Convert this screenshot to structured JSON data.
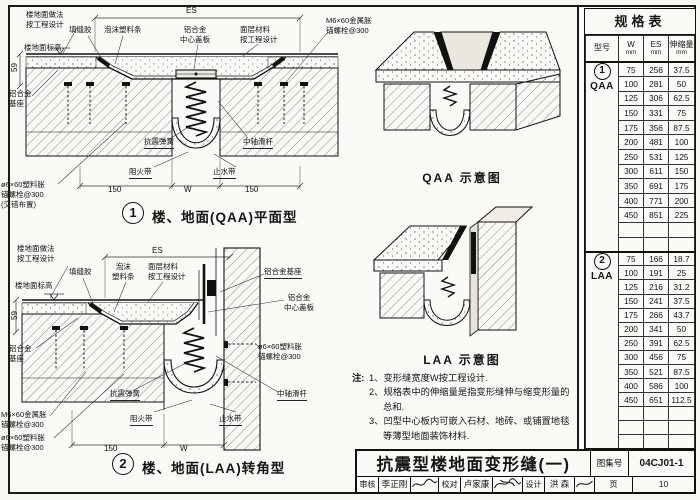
{
  "page": {
    "bg": "#f7f6f1",
    "line": "#1a1a1a"
  },
  "drawing1": {
    "caption_no": "1",
    "caption": "楼、地面(QAA)平面型",
    "dims": {
      "es": "ES",
      "h59": "59",
      "left150": "150",
      "w": "W",
      "right150": "150"
    },
    "labels": {
      "floor_finish": "楼地面做法\n按工程设计",
      "sealant": "填缝胶",
      "foam_strip": "泡沫塑料条",
      "alu_center_plate": "铝合金\n中心盖板",
      "surface_material": "面层材料\n按工程设计",
      "m6_anchor": "M6×60金属胀\n锚螺栓@300",
      "floor_level": "楼地面标高",
      "alu_base": "铝合金\n基座",
      "spring": "抗震弹簧",
      "slide_bar": "中轴滑杆",
      "fire_barrier": "阻火带",
      "water_stop": "止水带",
      "plastic_anchor": "ø6×60塑料胀\n锚螺栓@300\n(交错布置)"
    }
  },
  "drawing2": {
    "caption_no": "2",
    "caption": "楼、地面(LAA)转角型",
    "dims": {
      "es": "ES",
      "h59": "59",
      "left150": "150",
      "w": "W"
    },
    "labels": {
      "floor_finish": "楼地面做法\n按工程设计",
      "sealant": "填缝胶",
      "foam_strip": "泡沫\n塑料条",
      "surface_material": "面层材料\n按工程设计",
      "alu_base_right": "铝合金基座",
      "alu_center_plate": "铝合金\n中心盖板",
      "floor_level": "楼地面标高",
      "alu_base": "铝合金\n基座",
      "spring": "抗震弹簧",
      "plastic_anchor_right": "ø6×60塑料胀\n锚螺栓@300",
      "slide_bar": "中轴滑杆",
      "fire_barrier": "阻火带",
      "water_stop": "止水带",
      "m6_anchor_bl": "M6×60金属胀\n锚螺栓@300",
      "plastic_anchor_bl": "ø6×60塑料胀\n锚螺栓@300"
    }
  },
  "schematics": {
    "qaa_caption": "QAA 示意图",
    "laa_caption": "LAA 示意图"
  },
  "notes": {
    "prefix": "注:",
    "items": [
      "1、变形缝宽度W按工程设计.",
      "2、规格表中的伸缩量是指变形缝伸与缩变形量的总和.",
      "3、凹型中心板内可嵌入石材、地砖、或铺置地毯等薄型地面装饰材料."
    ]
  },
  "table": {
    "title": "规格表",
    "col_model": "型号",
    "col_w": "W",
    "col_es": "ES",
    "col_amount": "伸缩量",
    "unit": "mm",
    "groups": [
      {
        "no": "1",
        "model": "QAA",
        "empty_rows": 2,
        "rows": [
          [
            "75",
            "256",
            "37.5"
          ],
          [
            "100",
            "281",
            "50"
          ],
          [
            "125",
            "306",
            "62.5"
          ],
          [
            "150",
            "331",
            "75"
          ],
          [
            "175",
            "356",
            "87.5"
          ],
          [
            "200",
            "481",
            "100"
          ],
          [
            "250",
            "531",
            "125"
          ],
          [
            "300",
            "611",
            "150"
          ],
          [
            "350",
            "691",
            "175"
          ],
          [
            "400",
            "771",
            "200"
          ],
          [
            "450",
            "851",
            "225"
          ]
        ]
      },
      {
        "no": "2",
        "model": "LAA",
        "empty_rows": 3,
        "rows": [
          [
            "75",
            "166",
            "18.7"
          ],
          [
            "100",
            "191",
            "25"
          ],
          [
            "125",
            "216",
            "31.2"
          ],
          [
            "150",
            "241",
            "37.5"
          ],
          [
            "175",
            "266",
            "43.7"
          ],
          [
            "200",
            "341",
            "50"
          ],
          [
            "250",
            "391",
            "62.5"
          ],
          [
            "300",
            "456",
            "75"
          ],
          [
            "350",
            "521",
            "87.5"
          ],
          [
            "400",
            "586",
            "100"
          ],
          [
            "450",
            "651",
            "112.5"
          ]
        ]
      }
    ]
  },
  "titleblock": {
    "title": "抗震型楼地面变形缝(一)",
    "atlas_label": "图集号",
    "atlas_no": "04CJ01-1",
    "page_label": "页",
    "page_no": "10",
    "reviewer_label": "审核",
    "reviewer": "李正刚",
    "checker_label": "校对",
    "checker": "卢家康",
    "designer_label": "设计",
    "designer": "洪 森"
  }
}
